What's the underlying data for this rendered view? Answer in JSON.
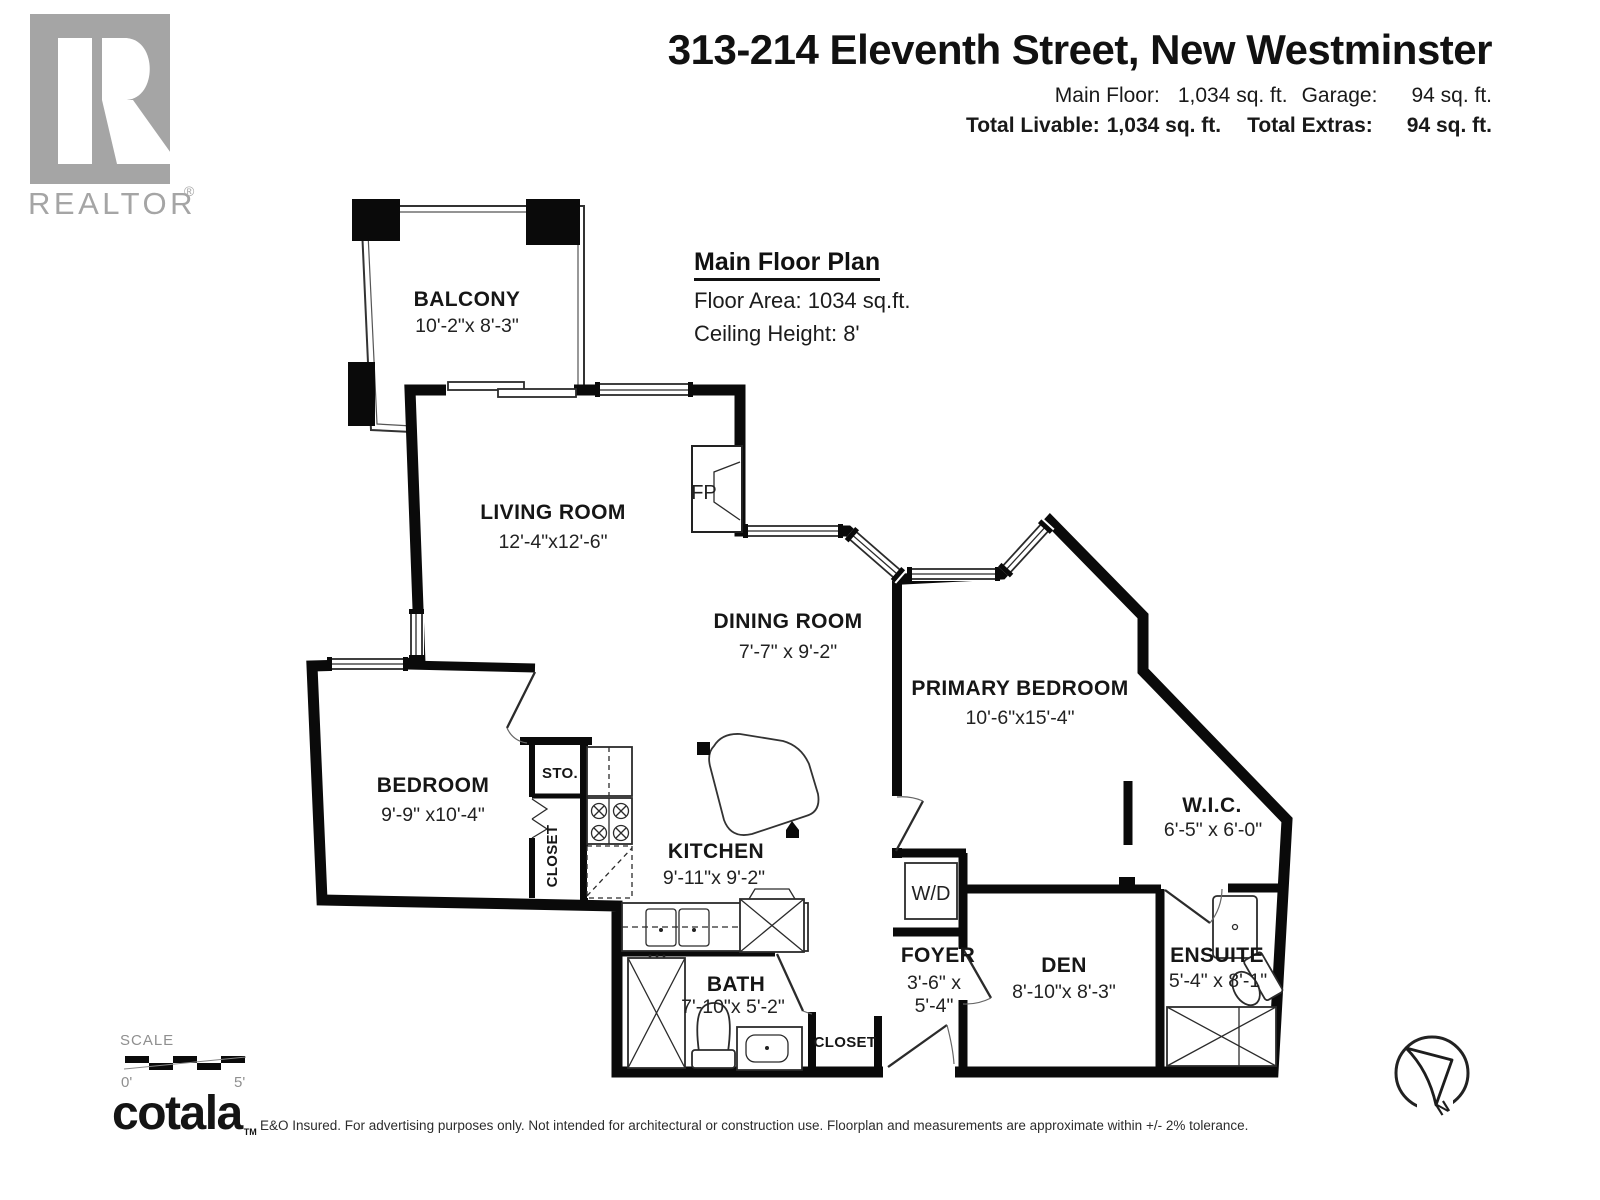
{
  "header": {
    "title": "313-214 Eleventh Street, New Westminster",
    "stats": {
      "main_floor_label": "Main Floor:",
      "main_floor_value": "1,034 sq. ft.",
      "garage_label": "Garage:",
      "garage_value": "94 sq. ft.",
      "total_livable_label": "Total Livable:",
      "total_livable_value": "1,034 sq. ft.",
      "total_extras_label": "Total Extras:",
      "total_extras_value": "94 sq. ft."
    }
  },
  "realtor_logo": {
    "wordmark": "REALTOR",
    "registered_mark": "®"
  },
  "plan_info": {
    "title": "Main Floor Plan",
    "floor_area": "Floor Area: 1034 sq.ft.",
    "ceiling_height": "Ceiling Height: 8'"
  },
  "rooms": {
    "balcony": {
      "name": "BALCONY",
      "dims": "10'-2\"x 8'-3\""
    },
    "living_room": {
      "name": "LIVING ROOM",
      "dims": "12'-4\"x12'-6\""
    },
    "dining_room": {
      "name": "DINING ROOM",
      "dims": "7'-7\" x 9'-2\""
    },
    "primary_bedroom": {
      "name": "PRIMARY BEDROOM",
      "dims": "10'-6\"x15'-4\""
    },
    "bedroom": {
      "name": "BEDROOM",
      "dims": "9'-9\" x10'-4\""
    },
    "kitchen": {
      "name": "KITCHEN",
      "dims": "9'-11\"x 9'-2\""
    },
    "wic": {
      "name": "W.I.C.",
      "dims": "6'-5\" x 6'-0\""
    },
    "bath": {
      "name": "BATH",
      "dims": "7'-10\"x 5'-2\""
    },
    "foyer": {
      "name": "FOYER",
      "dims_line1": "3'-6\" x",
      "dims_line2": "5'-4\""
    },
    "den": {
      "name": "DEN",
      "dims": "8'-10\"x 8'-3\""
    },
    "ensuite": {
      "name": "ENSUITE",
      "dims": "5'-4\" x 8'-1\""
    }
  },
  "labels": {
    "hall_closet": "CLOSET",
    "bedroom_closet": "CLOSET",
    "storage": "STO.",
    "washer_dryer": "W/D",
    "fireplace": "FP"
  },
  "scale_bar": {
    "label": "SCALE",
    "start": "0'",
    "end": "5'"
  },
  "footer": {
    "brand": "cotala",
    "brand_tm": "TM",
    "disclaimer": "E&O Insured. For advertising purposes only. Not intended for architectural or construction use. Floorplan and measurements are approximate within +/- 2% tolerance."
  },
  "compass": {
    "north": "N"
  },
  "colors": {
    "wall": "#0a0a0a",
    "logo_gray": "#a5a5a5",
    "text_dark": "#1a1a1a",
    "muted": "#8f8f8f"
  }
}
